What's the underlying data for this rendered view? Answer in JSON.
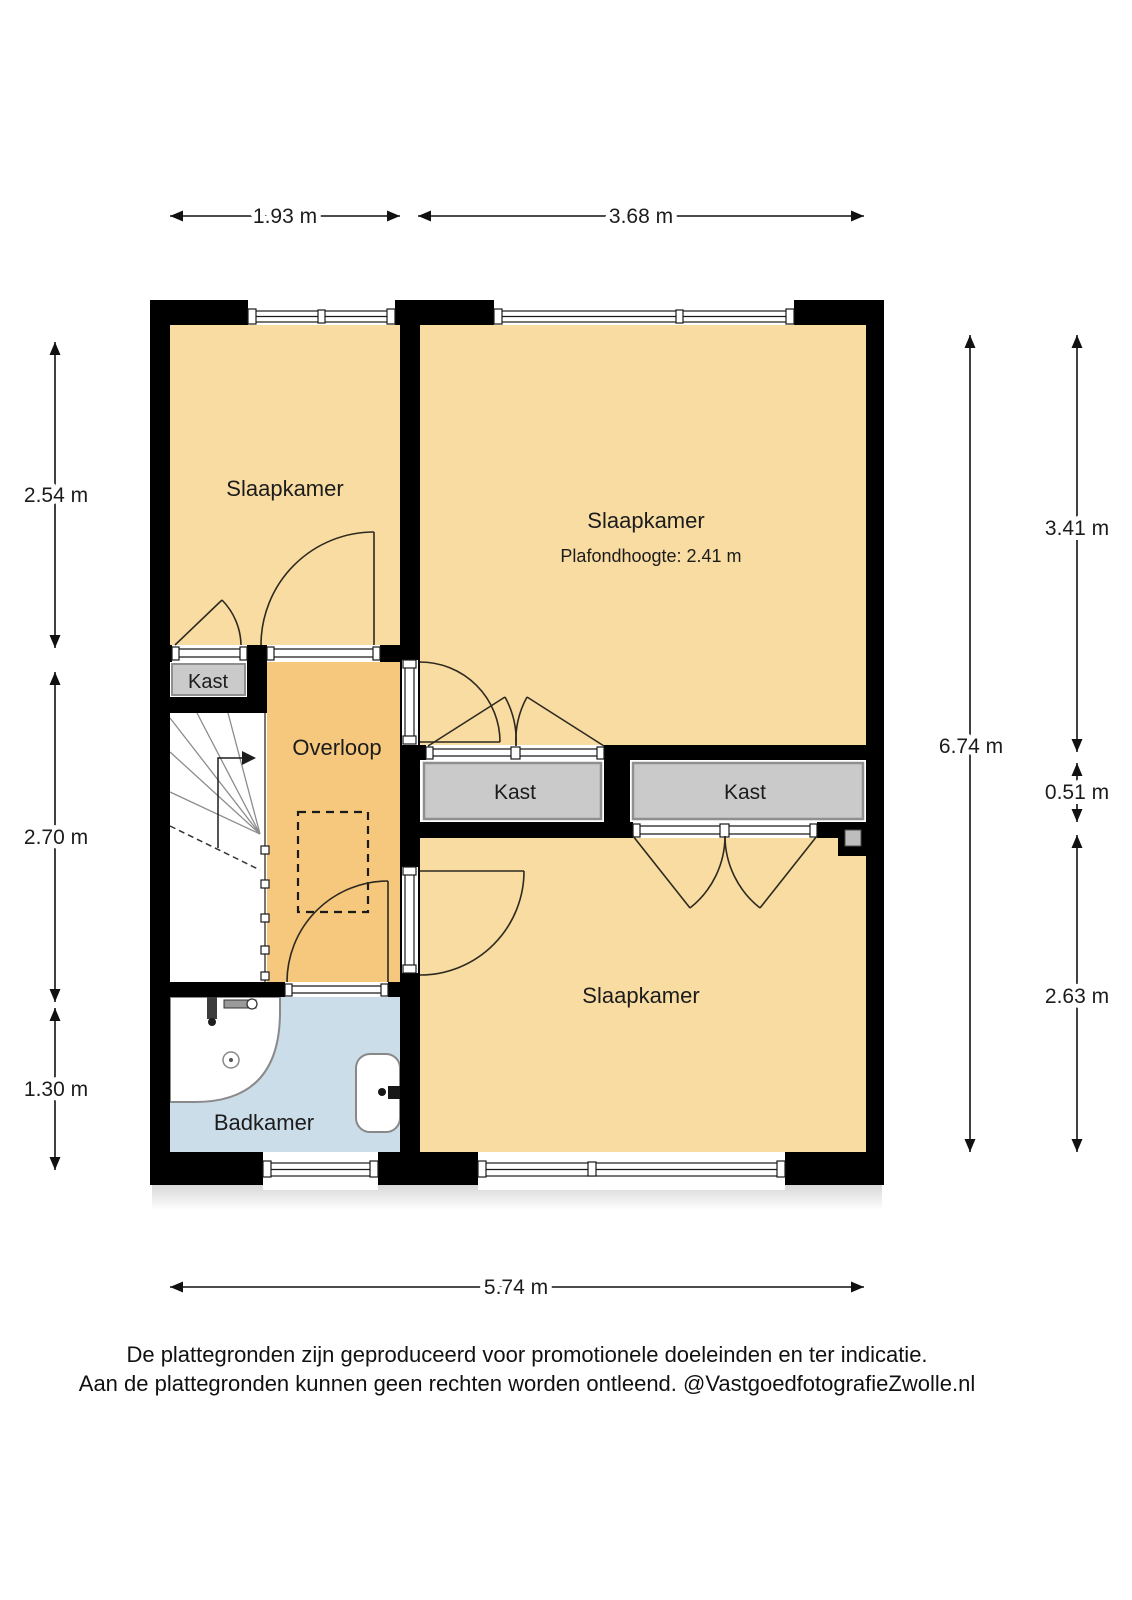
{
  "plan": {
    "rooms": {
      "bedroom_top_left": {
        "label": "Slaapkamer"
      },
      "bedroom_top_right": {
        "label": "Slaapkamer",
        "sublabel": "Plafondhoogte: 2.41 m"
      },
      "bedroom_bottom": {
        "label": "Slaapkamer"
      },
      "closet_small": {
        "label": "Kast"
      },
      "closet_middle": {
        "label": "Kast"
      },
      "closet_right": {
        "label": "Kast"
      },
      "landing": {
        "label": "Overloop"
      },
      "bathroom": {
        "label": "Badkamer"
      }
    },
    "colors": {
      "wall": "#000000",
      "room": "#F8DCA2",
      "landing": "#F5C87D",
      "closet": "#CACACA",
      "closet_border": "#8F8F8F",
      "bathroom": "#CBDDE8",
      "stairs": "#FFFFFF"
    },
    "dimensions": {
      "top": [
        "1.93 m",
        "3.68 m"
      ],
      "left": [
        "2.54 m",
        "2.70 m",
        "1.30 m"
      ],
      "right_inner": "6.74 m",
      "right_outer": [
        "3.41 m",
        "0.51 m",
        "2.63 m"
      ],
      "bottom": "5.74 m"
    }
  },
  "footer": {
    "line1": "De plattegronden zijn geproduceerd voor promotionele doeleinden en ter indicatie.",
    "line2": "Aan de plattegronden kunnen geen rechten worden ontleend. @VastgoedfotografieZwolle.nl"
  }
}
